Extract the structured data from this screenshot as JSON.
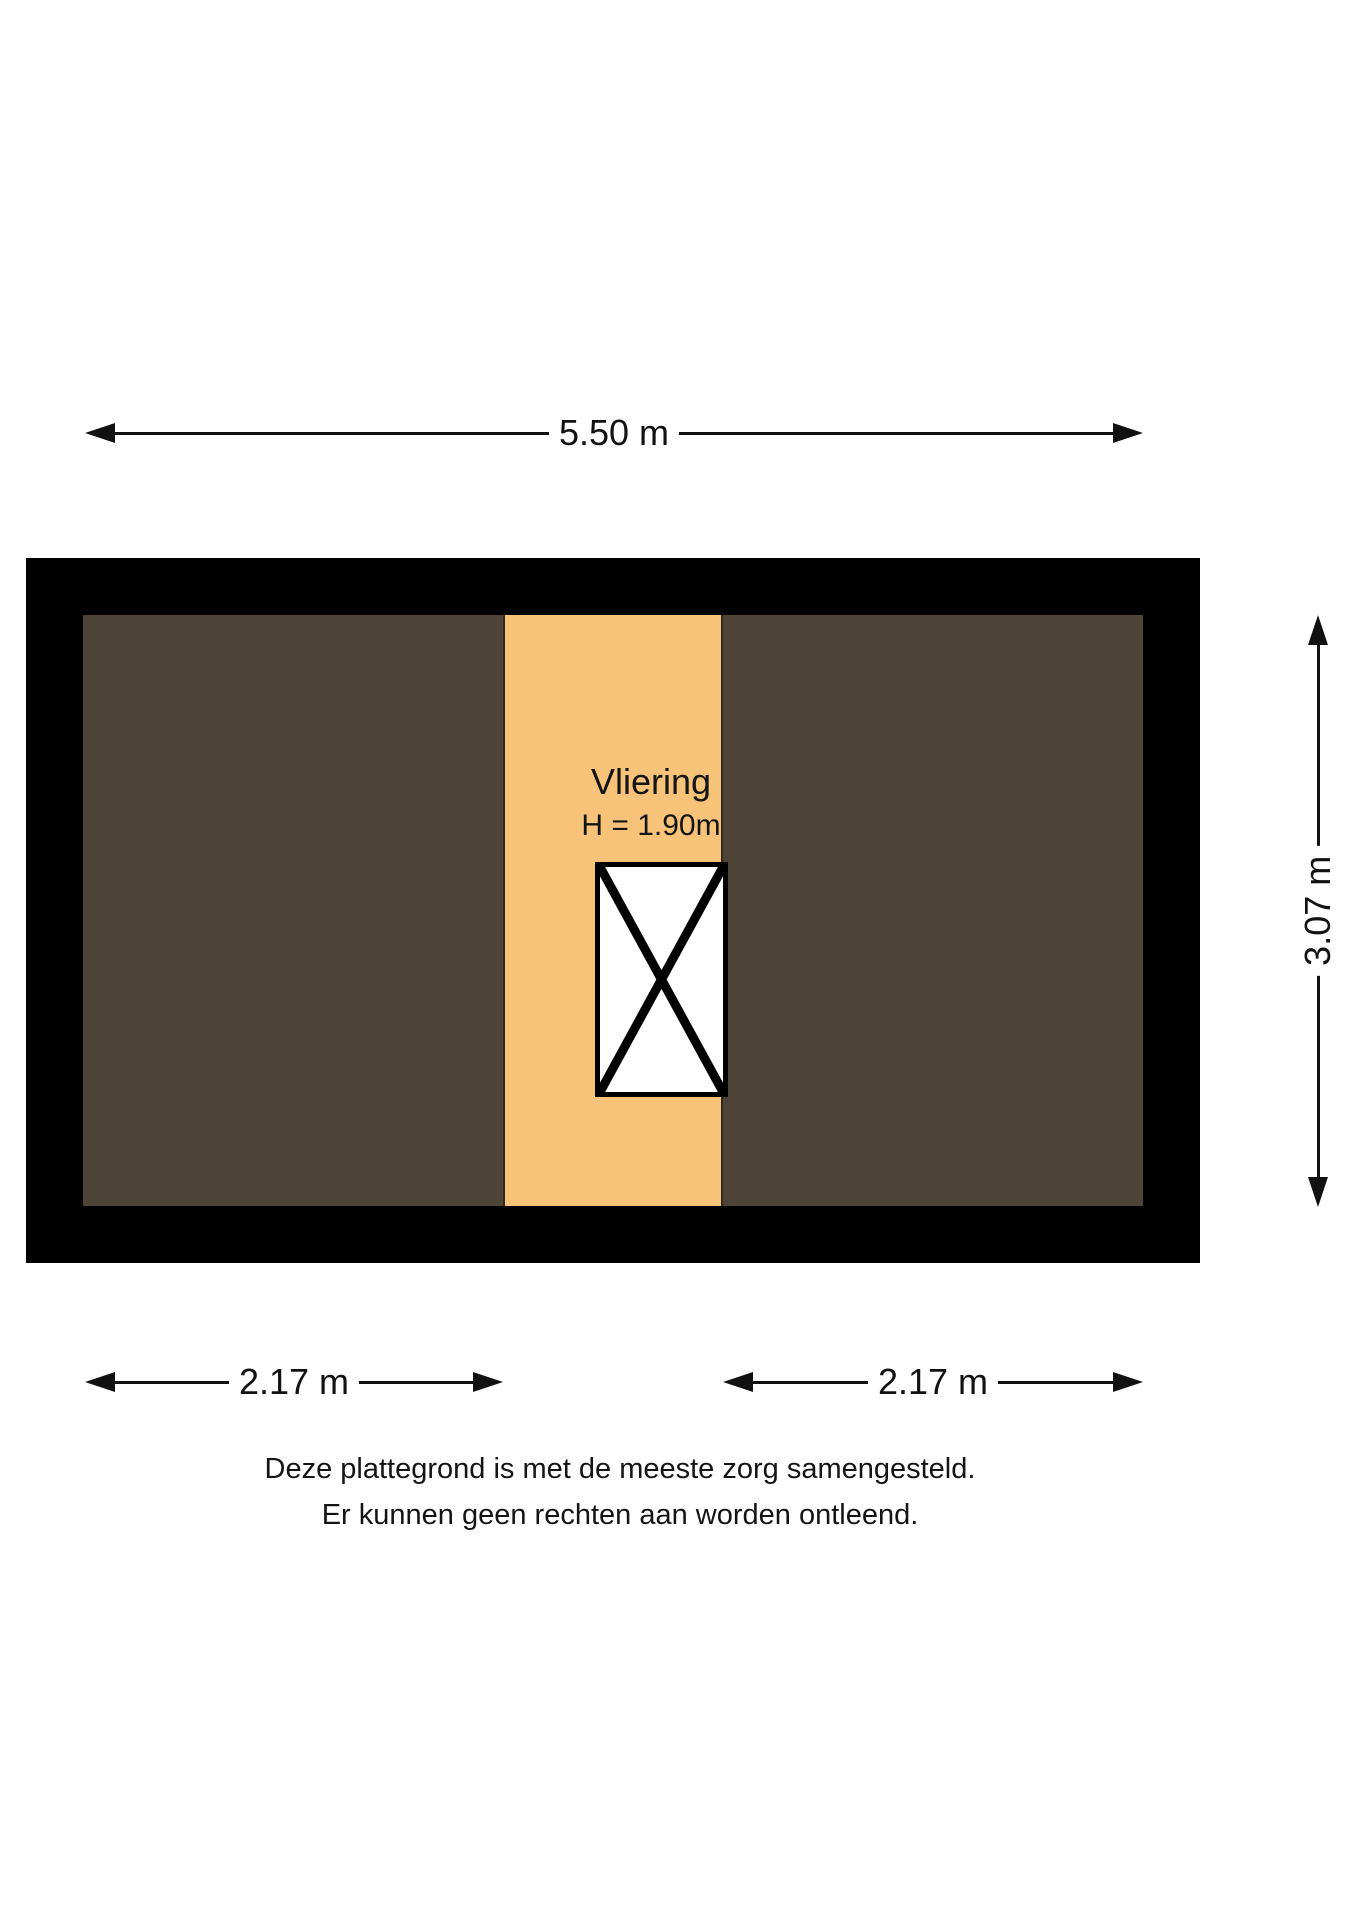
{
  "floorplan": {
    "room": {
      "name": "Vliering",
      "height_label": "H = 1.90m"
    },
    "dimensions": {
      "top": "5.50 m",
      "right": "3.07 m",
      "bottom_left": "2.17 m",
      "bottom_right": "2.17 m"
    },
    "disclaimer": {
      "line1": "Deze plattegrond is met de meeste zorg samengesteld.",
      "line2": "Er kunnen geen rechten aan worden ontleend."
    },
    "colors": {
      "wall": "#000000",
      "room_dark": "#4d4336",
      "attic_floor": "#f7c379",
      "strip_border": "#2e281f",
      "stairs_fill": "#ffffff",
      "line": "#111111"
    },
    "icons": {
      "dimension_arrowheads": "filled-triangle",
      "stairs_cross": "x-cross"
    }
  }
}
